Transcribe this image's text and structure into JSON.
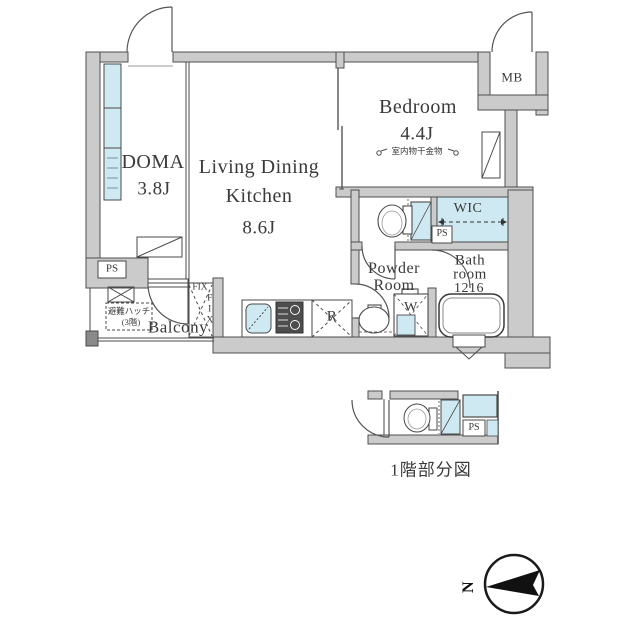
{
  "plan": {
    "rooms": {
      "doma": {
        "name": "DOMA",
        "size": "3.8J"
      },
      "ldk": {
        "line1": "Living Dining",
        "line2": "Kitchen",
        "size": "8.6J"
      },
      "bedroom": {
        "name": "Bedroom",
        "size": "4.4J",
        "note": "室内物干金物"
      },
      "powder_room": {
        "line1": "Powder",
        "line2": "Room"
      },
      "bathroom": {
        "line1": "Bath",
        "line2": "room",
        "size": "1216"
      },
      "wic": {
        "name": "WIC"
      },
      "mb": {
        "name": "MB"
      },
      "balcony": {
        "name": "Balcony",
        "hatch": "避難ハッチ",
        "hatch_floor": "(3階)"
      }
    },
    "fixtures": {
      "fridge": "R",
      "washer": "W",
      "pipe_space": "PS",
      "fix_window": "FIX"
    }
  },
  "detail": {
    "caption": "1階部分図",
    "pipe_space": "PS"
  },
  "compass": {
    "north": "N"
  },
  "colors": {
    "wall": "#cbcbcb",
    "window_blue": "#cfe9f2",
    "line": "#4a4a4a"
  }
}
